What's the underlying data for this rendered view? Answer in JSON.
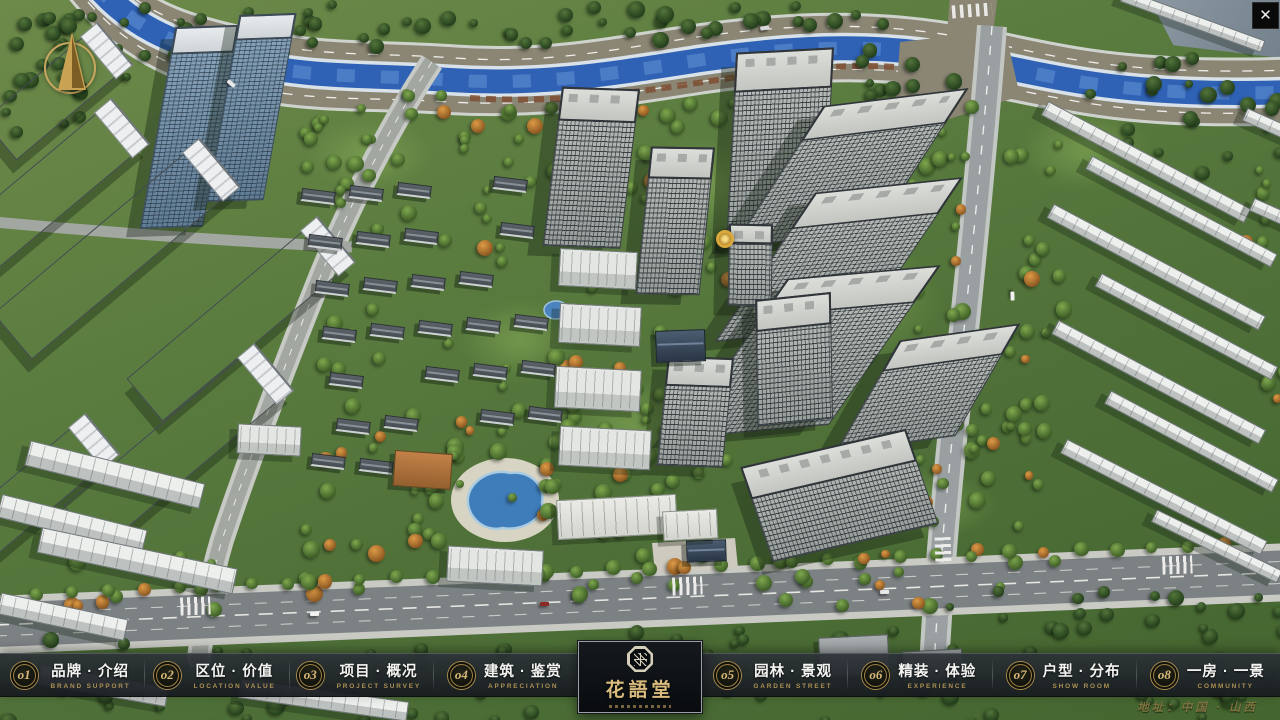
{
  "app": {
    "close_glyph": "✕"
  },
  "logo": {
    "title": "花語堂"
  },
  "nav": {
    "items": [
      {
        "num": "o1",
        "zh": "品牌 · 介绍",
        "en": "BRAND SUPPORT"
      },
      {
        "num": "o2",
        "zh": "区位 · 价值",
        "en": "LOCATION VALUE"
      },
      {
        "num": "o3",
        "zh": "项目 · 概况",
        "en": "PROJECT SURVEY"
      },
      {
        "num": "o4",
        "zh": "建筑 · 鉴赏",
        "en": "APPRECIATION"
      },
      {
        "num": "o5",
        "zh": "园林 · 景观",
        "en": "GARDEN STREET"
      },
      {
        "num": "o6",
        "zh": "精装 · 体验",
        "en": "EXPERIENCE"
      },
      {
        "num": "o7",
        "zh": "户型 · 分布",
        "en": "SHOW ROOM"
      },
      {
        "num": "o8",
        "zh": "一房 · 一景",
        "en": "COMMUNITY"
      }
    ]
  },
  "footer": {
    "address": "地址：中国 · 山西"
  },
  "colors": {
    "gold": "#d8b876",
    "nav_bg": "#1d2226",
    "river": "#3f7cba",
    "road": "#8b8574",
    "grass": "#5a7c3f"
  }
}
